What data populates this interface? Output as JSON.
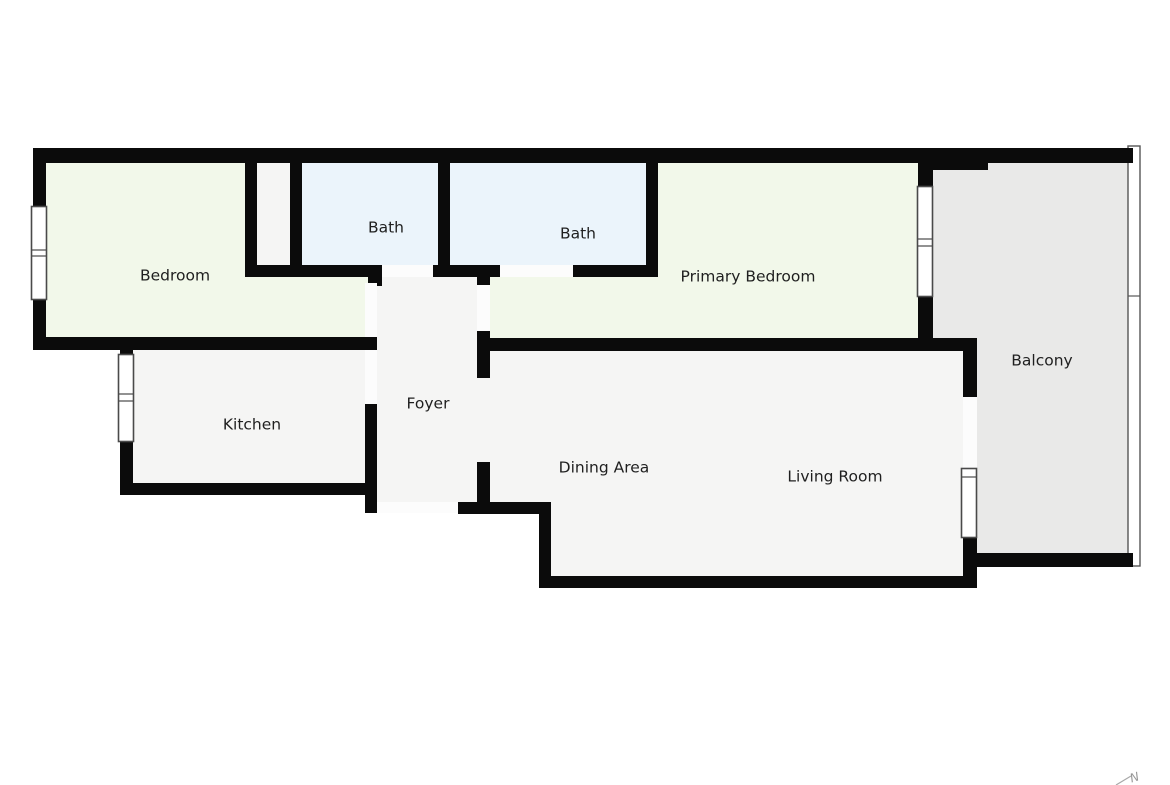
{
  "floorplan": {
    "title": "Apartment floor plan",
    "rooms": [
      {
        "id": "bedroom",
        "label": "Bedroom",
        "label_x": 175,
        "label_y": 276,
        "fill_class": "floor-green"
      },
      {
        "id": "bath-1",
        "label": "Bath",
        "label_x": 386,
        "label_y": 228,
        "fill_class": "floor-blue"
      },
      {
        "id": "bath-2",
        "label": "Bath",
        "label_x": 578,
        "label_y": 234,
        "fill_class": "floor-blue"
      },
      {
        "id": "primary-bedroom",
        "label": "Primary Bedroom",
        "label_x": 748,
        "label_y": 277,
        "fill_class": "floor-green"
      },
      {
        "id": "balcony",
        "label": "Balcony",
        "label_x": 1042,
        "label_y": 361,
        "fill_class": "floor-balcony"
      },
      {
        "id": "kitchen",
        "label": "Kitchen",
        "label_x": 252,
        "label_y": 425,
        "fill_class": "floor-gray"
      },
      {
        "id": "foyer",
        "label": "Foyer",
        "label_x": 428,
        "label_y": 404,
        "fill_class": "floor-gray"
      },
      {
        "id": "dining-area",
        "label": "Dining Area",
        "label_x": 604,
        "label_y": 468,
        "fill_class": "floor-gray"
      },
      {
        "id": "living-room",
        "label": "Living Room",
        "label_x": 835,
        "label_y": 477,
        "fill_class": "floor-gray"
      }
    ],
    "compass": {
      "label": "N"
    },
    "colors": {
      "wall": "#0b0b0b",
      "floor_gray": "#f5f5f4",
      "floor_green": "#f2f8ea",
      "floor_blue": "#ebf4fb",
      "balcony_gray": "#e9e9e8",
      "door": "#fcfcfc",
      "window_frame": "#4a4a4a",
      "label": "#1f1f1f",
      "compass": "#979797"
    }
  }
}
